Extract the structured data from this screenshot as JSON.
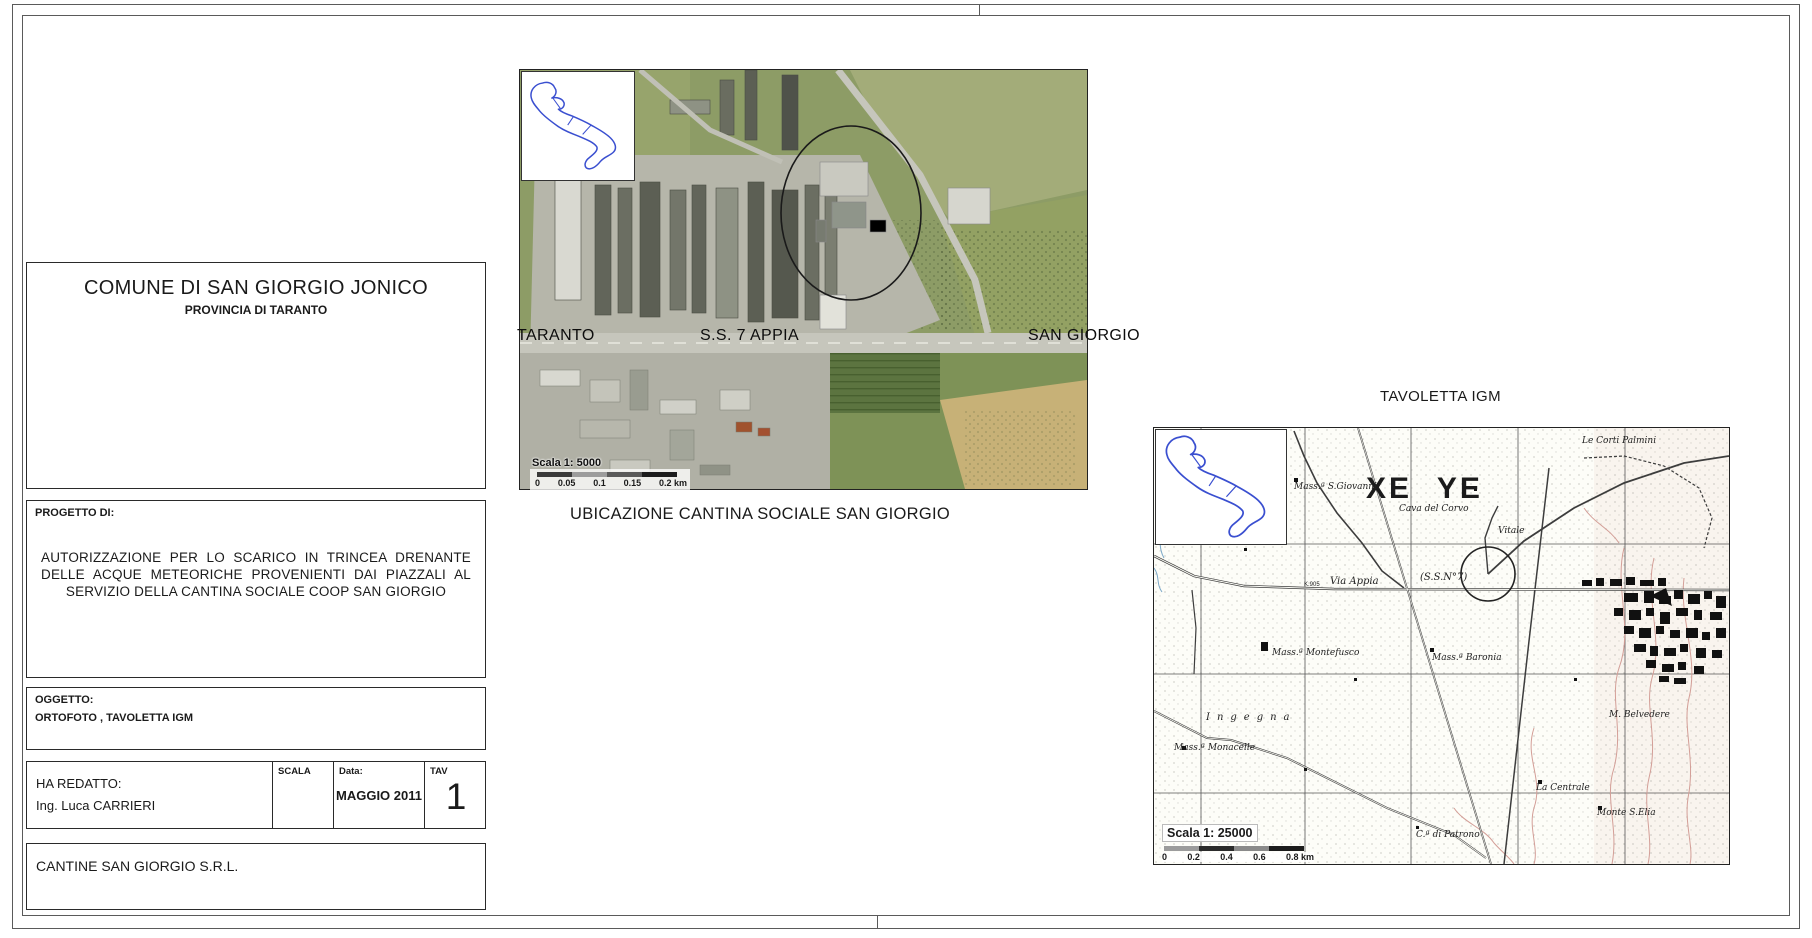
{
  "title_block": {
    "header": {
      "line1": "COMUNE DI SAN GIORGIO JONICO",
      "line2": "PROVINCIA DI TARANTO"
    },
    "progetto": {
      "label": "PROGETTO DI:",
      "text": "AUTORIZZAZIONE PER LO SCARICO IN TRINCEA DRENANTE DELLE ACQUE METEORICHE PROVENIENTI DAI PIAZZALI AL SERVIZIO DELLA CANTINA SOCIALE COOP SAN GIORGIO"
    },
    "oggetto": {
      "label": "OGGETTO:",
      "text": "ORTOFOTO , TAVOLETTA IGM"
    },
    "redatto": {
      "label": "HA REDATTO:",
      "name": "Ing. Luca CARRIERI",
      "scala_label": "SCALA",
      "data_label": "Data:",
      "data_value": "MAGGIO 2011",
      "tav_label": "TAV",
      "tav_value": "1"
    },
    "company": "CANTINE SAN GIORGIO  S.R.L."
  },
  "ortofoto": {
    "label_left": "TARANTO",
    "label_center": "S.S. 7 APPIA",
    "label_right": "SAN GIORGIO",
    "scale_title": "Scala 1: 5000",
    "scale_ticks": [
      "0",
      "0.05",
      "0.1",
      "0.15",
      "0.2 km"
    ],
    "caption": "UBICAZIONE CANTINA SOCIALE SAN GIORGIO"
  },
  "igm": {
    "title": "TAVOLETTA IGM",
    "grid_code": "XE YE",
    "scale_title": "Scala 1: 25000",
    "scale_ticks": [
      "0",
      "0.2",
      "0.4",
      "0.6",
      "0.8 km"
    ],
    "labels": [
      {
        "text": "Le Corti Palmini",
        "x": 428,
        "y": 8,
        "cls": "cursive"
      },
      {
        "text": "Mass.ª S.Giovanni",
        "x": 140,
        "y": 54,
        "cls": "cursive"
      },
      {
        "text": "Cava del Corvo",
        "x": 245,
        "y": 76,
        "cls": "cursive"
      },
      {
        "text": "Vitale",
        "x": 344,
        "y": 98,
        "cls": "cursive"
      },
      {
        "text": "(S.S.N°7)",
        "x": 266,
        "y": 144,
        "cls": "italic"
      },
      {
        "text": "Via Appia",
        "x": 176,
        "y": 148,
        "cls": "italic"
      },
      {
        "text": "K.905",
        "x": 150,
        "y": 154,
        "cls": "tiny"
      },
      {
        "text": "Mass.ª Montefusco",
        "x": 118,
        "y": 220,
        "cls": "cursive"
      },
      {
        "text": "Mass.ª Baronia",
        "x": 278,
        "y": 225,
        "cls": "cursive"
      },
      {
        "text": "Ingegna",
        "x": 52,
        "y": 284,
        "cls": "spaced"
      },
      {
        "text": "Mass.ª Monacelle",
        "x": 20,
        "y": 315,
        "cls": "cursive"
      },
      {
        "text": "M. Belvedere",
        "x": 455,
        "y": 282,
        "cls": "cursive"
      },
      {
        "text": "La Centrale",
        "x": 382,
        "y": 355,
        "cls": "cursive"
      },
      {
        "text": "Monte S.Elia",
        "x": 443,
        "y": 380,
        "cls": "cursive"
      },
      {
        "text": "C.ª di Patrono",
        "x": 262,
        "y": 402,
        "cls": "cursive"
      }
    ]
  },
  "colors": {
    "inset_outline": "#3a4fd0",
    "annotation_circle": "#1a1a1a",
    "contour": "#d39e97",
    "road_gray": "#c6c6bc",
    "field_green": "#8d9c66",
    "field_tan": "#c7b177"
  }
}
